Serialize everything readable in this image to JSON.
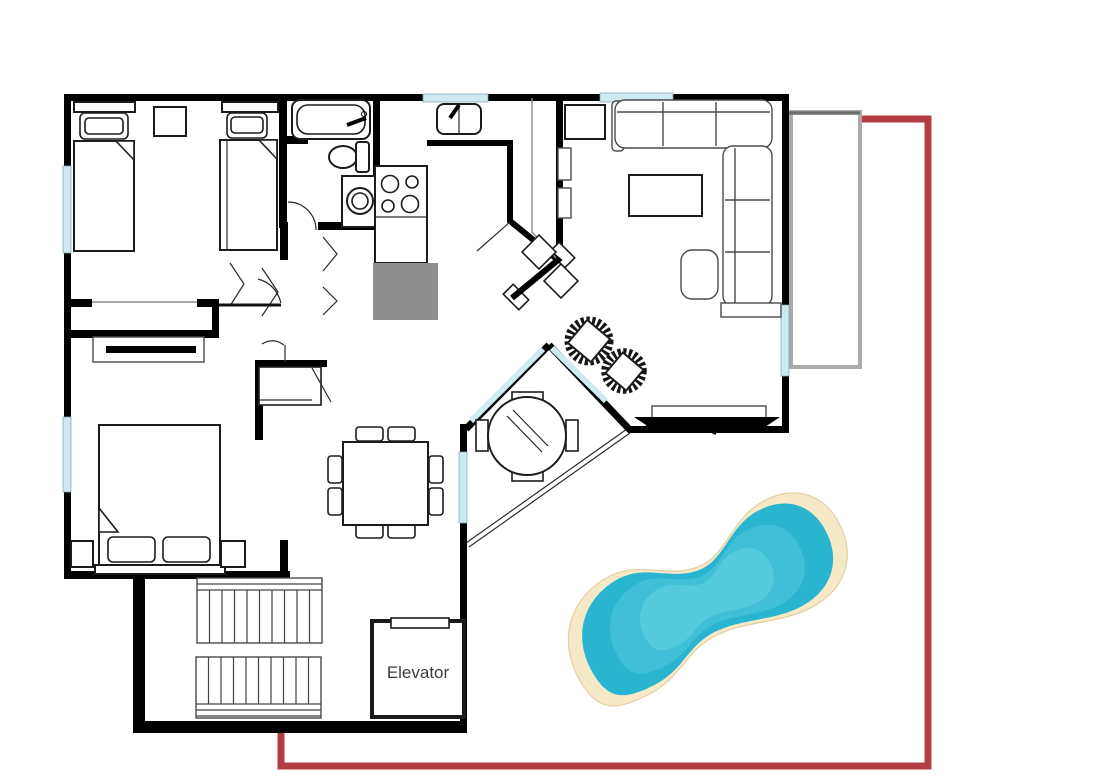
{
  "page": {
    "type": "apartment-floor-plan"
  },
  "labels": {
    "elevator": "Elevator"
  },
  "colors": {
    "wall": "#000000",
    "window": "#cfe9f0",
    "property_line_red": "#b23c41",
    "balcony_gray": "#ababab",
    "kitchen_block_gray": "#8e8e8e",
    "pool_sand": "#f6e9c8",
    "pool_sand_edge": "#e8d5ae",
    "pool_water_edge": "#29b4d0",
    "pool_water_mid": "#3fc0d8",
    "pool_water_center": "#55cade"
  }
}
